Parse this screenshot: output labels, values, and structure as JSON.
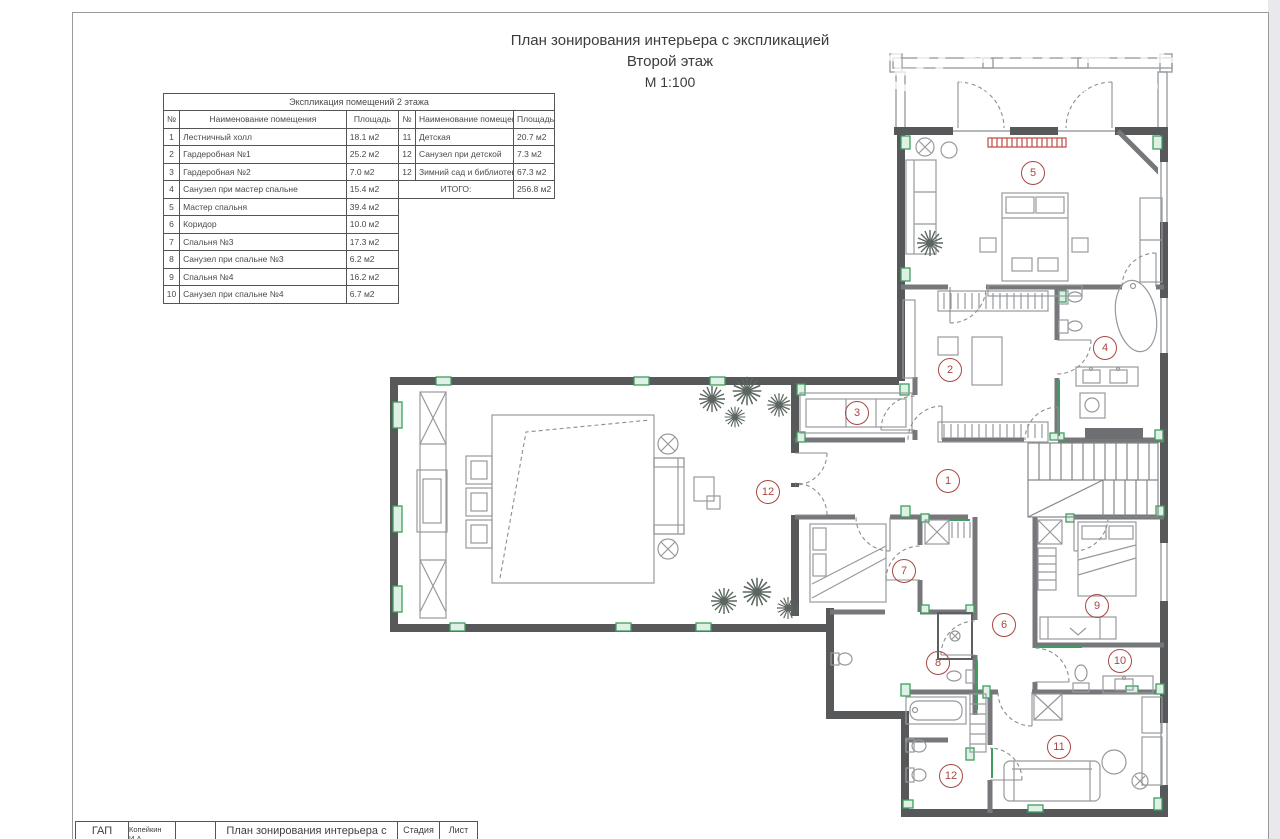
{
  "page": {
    "title_line1": "План зонирования интерьера с экспликацией",
    "title_line2": "Второй этаж",
    "title_line3": "М 1:100"
  },
  "watermark": {
    "brand": "ONREALT",
    "subtitle": "НЕДВИЖИМОСТЬ",
    "icon": "house-in-circle-icon"
  },
  "explication_table": {
    "title": "Экспликация помещений 2 этажа",
    "columns": [
      "№",
      "Наименование помещения",
      "Площадь"
    ],
    "left_rows": [
      {
        "num": "1",
        "name": "Лестничный холл",
        "area": "18.1 м2"
      },
      {
        "num": "2",
        "name": "Гардеробная №1",
        "area": "25.2 м2"
      },
      {
        "num": "3",
        "name": "Гардеробная №2",
        "area": "7.0 м2"
      },
      {
        "num": "4",
        "name": "Санузел при мастер спальне",
        "area": "15.4 м2"
      },
      {
        "num": "5",
        "name": "Мастер спальня",
        "area": "39.4 м2"
      },
      {
        "num": "6",
        "name": "Коридор",
        "area": "10.0 м2"
      },
      {
        "num": "7",
        "name": "Спальня №3",
        "area": "17.3 м2"
      },
      {
        "num": "8",
        "name": "Санузел при спальне №3",
        "area": "6.2 м2"
      },
      {
        "num": "9",
        "name": "Спальня №4",
        "area": "16.2 м2"
      },
      {
        "num": "10",
        "name": "Санузел при спальне №4",
        "area": "6.7 м2"
      }
    ],
    "right_rows": [
      {
        "num": "11",
        "name": "Детская",
        "area": "20.7 м2"
      },
      {
        "num": "12",
        "name": "Санузел при детской",
        "area": "7.3 м2"
      },
      {
        "num": "12",
        "name": "Зимний сад и библиотека",
        "area": "67.3 м2"
      }
    ],
    "total_label": "ИТОГО:",
    "total_value": "256.8 м2"
  },
  "floor_plan": {
    "scale_note": "М 1:100",
    "room_markers": [
      {
        "num": "1",
        "x": 947,
        "y": 480
      },
      {
        "num": "2",
        "x": 949,
        "y": 369
      },
      {
        "num": "3",
        "x": 856,
        "y": 412
      },
      {
        "num": "4",
        "x": 1104,
        "y": 347
      },
      {
        "num": "5",
        "x": 1032,
        "y": 172
      },
      {
        "num": "6",
        "x": 1003,
        "y": 624
      },
      {
        "num": "7",
        "x": 903,
        "y": 570
      },
      {
        "num": "8",
        "x": 937,
        "y": 662
      },
      {
        "num": "9",
        "x": 1096,
        "y": 605
      },
      {
        "num": "10",
        "x": 1119,
        "y": 660
      },
      {
        "num": "11",
        "x": 1058,
        "y": 746
      },
      {
        "num": "12",
        "x": 767,
        "y": 491
      },
      {
        "num": "12",
        "x": 950,
        "y": 775
      }
    ],
    "colors": {
      "wall": "#57585a",
      "accent_green": "#3f9d5f",
      "marker_red": "#a8473f",
      "radiator_red": "#bf4a42"
    }
  },
  "title_block": {
    "cells": [
      {
        "label": "ГАП"
      },
      {
        "label": "Копейкин И.А."
      },
      {
        "label": ""
      },
      {
        "label": "План зонирования интерьера с"
      },
      {
        "label": "Стадия"
      },
      {
        "label": "Лист"
      }
    ]
  }
}
